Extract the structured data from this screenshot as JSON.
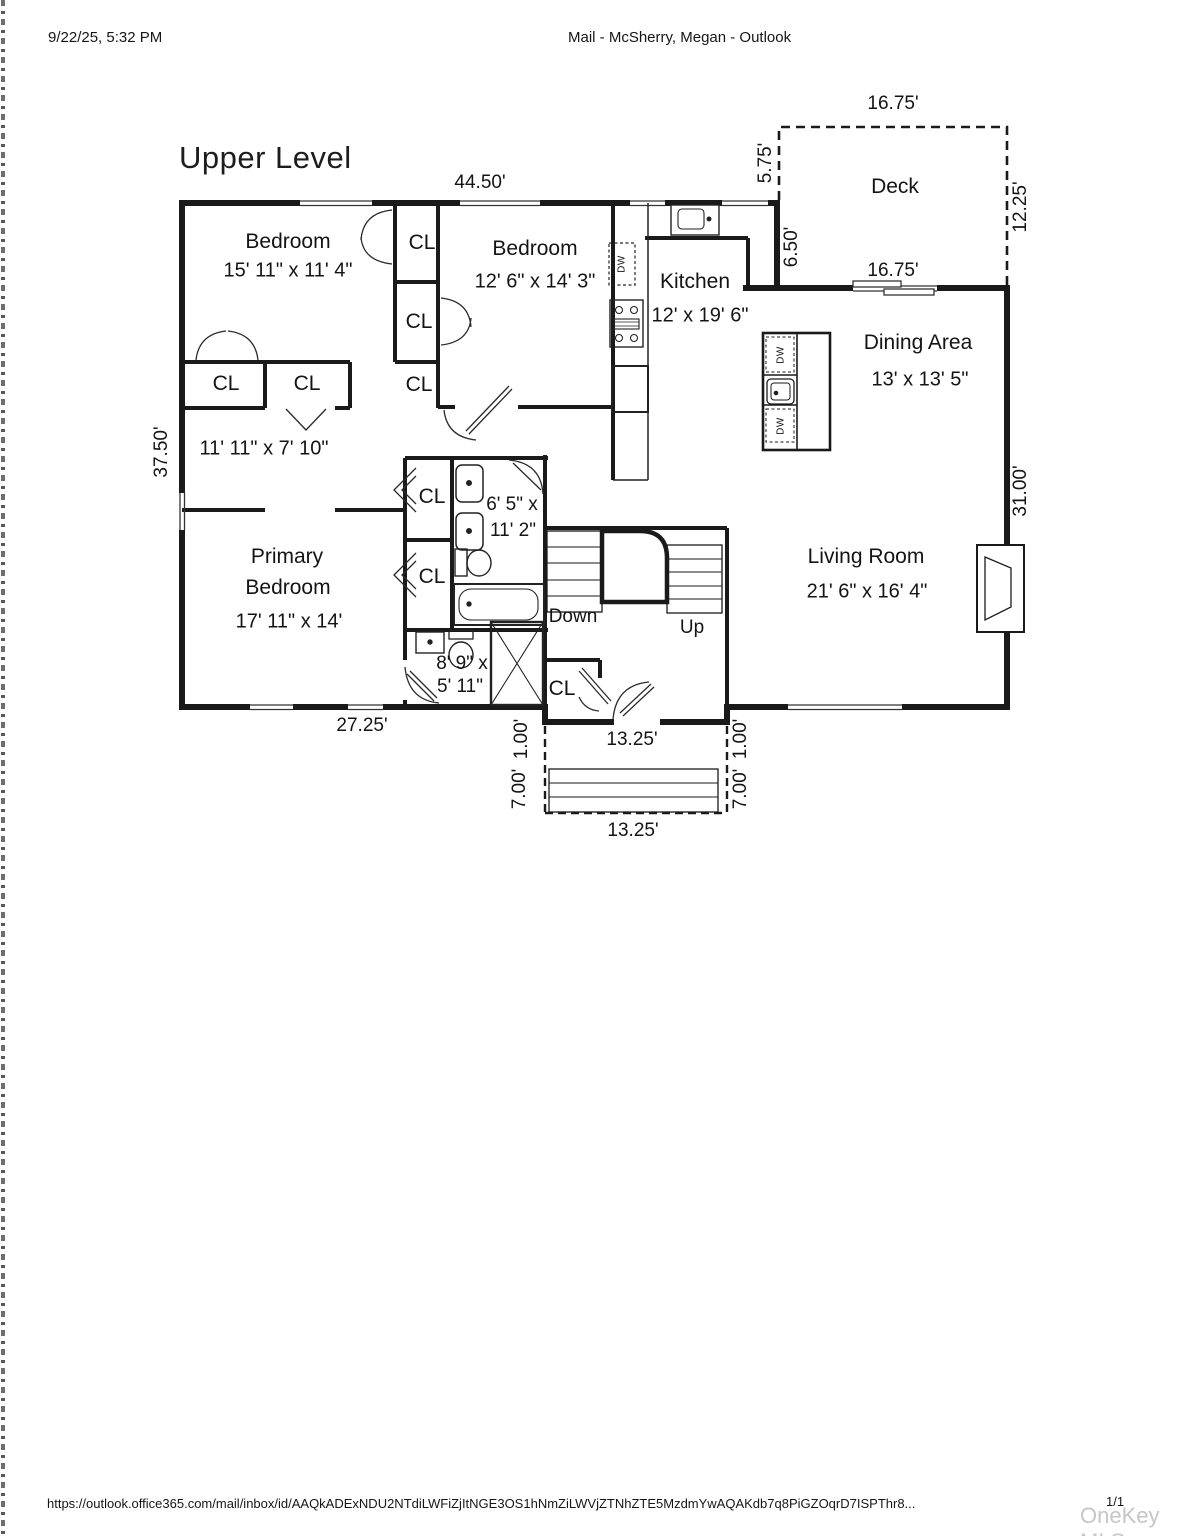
{
  "header": {
    "datetime": "9/22/25, 5:32 PM",
    "title": "Mail - McSherry, Megan - Outlook"
  },
  "floorplan": {
    "title": "Upper Level",
    "closet_label": "CL",
    "appliances": {
      "dishwasher_label": "DW"
    },
    "stairs": {
      "down": "Down",
      "up": "Up"
    },
    "rooms": {
      "bedroom_top_left": {
        "name": "Bedroom",
        "dims": "15' 11\" x 11' 4\""
      },
      "bedroom_top_mid": {
        "name": "Bedroom",
        "dims": "12' 6\" x 14' 3\""
      },
      "kitchen": {
        "name": "Kitchen",
        "dims": "12' x 19' 6\""
      },
      "deck": {
        "name": "Deck"
      },
      "dining": {
        "name": "Dining Area",
        "dims": "13' x 13' 5\""
      },
      "hall": {
        "dims": "11' 11\" x 7' 10\""
      },
      "bath_main": {
        "dims_line1": "6' 5\" x",
        "dims_line2": "11' 2\""
      },
      "primary": {
        "name_line1": "Primary",
        "name_line2": "Bedroom",
        "dims": "17' 11\" x 14'"
      },
      "bath_small": {
        "dims_line1": "8' 9\" x",
        "dims_line2": "5' 11\""
      },
      "living": {
        "name": "Living Room",
        "dims": "21' 6\" x 16' 4\""
      }
    },
    "dimensions": [
      "44.50'",
      "16.75'",
      "5.75'",
      "12.25'",
      "6.50'",
      "16.75'",
      "37.50'",
      "31.00'",
      "27.25'",
      "13.25'",
      "1.00'",
      "1.00'",
      "7.00'",
      "7.00'",
      "13.25'"
    ]
  },
  "footer": {
    "url": "https://outlook.office365.com/mail/inbox/id/AAQkADExNDU2NTdiLWFiZjItNGE3OS1hNmZiLWVjZTNhZTE5MzdmYwAQAKdb7q8PiGZOqrD7ISPThr8...",
    "page_indicator": "1/1",
    "watermark": "OneKey MLS"
  }
}
